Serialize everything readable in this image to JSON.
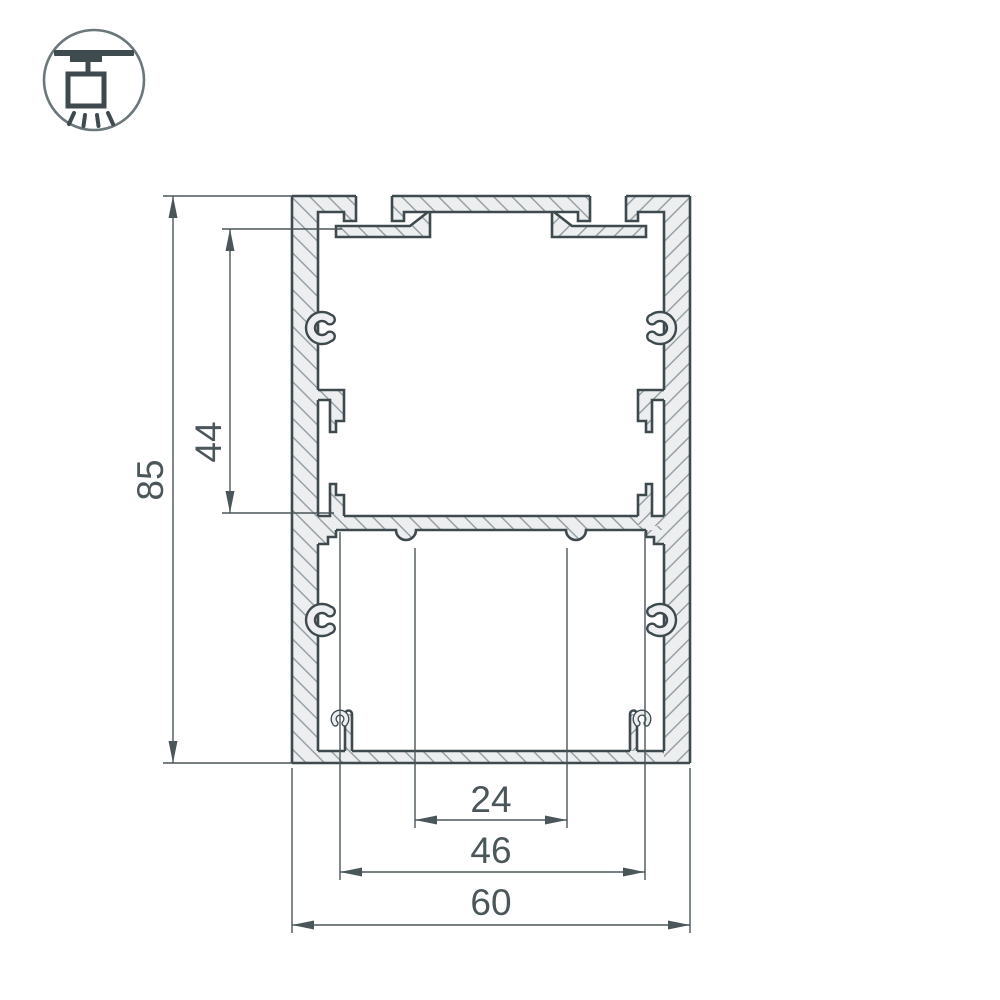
{
  "icon": {
    "name": "surface-mounted-ceiling-light-icon"
  },
  "dimensions": {
    "overall_height": "85",
    "upper_cavity_height": "44",
    "hole_spacing": "24",
    "inner_width": "46",
    "overall_width": "60"
  },
  "colors": {
    "outline": "#3e4a4e",
    "metal_fill": "#eceeef",
    "hatch": "#8b959a",
    "dimension": "#4b565a",
    "icon_stroke": "#6b777b",
    "background": "#ffffff"
  }
}
